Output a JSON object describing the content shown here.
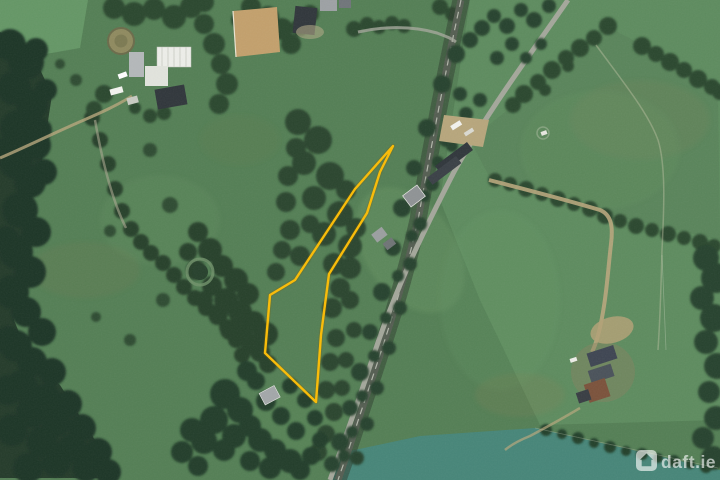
{
  "view": {
    "name": "satellite-map-view",
    "width": 720,
    "height": 480
  },
  "watermark": {
    "label": "daft.ie",
    "icon": "daft-house-icon",
    "color": "#FFFFFF",
    "opacity": 0.6
  },
  "boundary": {
    "label": "property-boundary-outline",
    "color": "#FBBC04",
    "underglow": "#7A5E00",
    "stroke_width": 2.4,
    "points": "393,146 380,172 367,213 329,274 321,335 316,402 265,353 270,295 295,280 355,189"
  },
  "scene": {
    "palette": {
      "field_base": "#547F55",
      "field_light": "#5E8C5F",
      "field_bright": "#659766",
      "field_teal": "#478679",
      "forest": "#243B2A",
      "forest_blob": "#1F3526",
      "hedge": "#2A462F",
      "corridor_shadow": "#2E3C2E",
      "road": "#A4A79B",
      "rail": "#555E52",
      "rail_line": "#C9CCC0",
      "track_tan": "#B7A67C",
      "arena_sand": "#C3A06C",
      "roof_white": "#EDEEE9",
      "roof_dark": "#30363B",
      "roof_grey": "#9B9FA0",
      "roof_brown": "#7B523B"
    },
    "paths": {
      "main_road": "M568,0 C530,55 492,105 455,170 C420,238 395,290 372,360 C352,420 340,452 330,480",
      "railway": "M461,0 C448,60 436,120 418,220 C400,300 378,360 355,430 C347,455 342,468 338,480",
      "farm_track_right": "M489,180 C520,188 560,198 600,210 C612,215 613,228 611,244 C608,270 607,290 603,312 C600,330 596,344 592,352",
      "farm_lane_bottom_right": "M580,408 C560,420 545,428 530,436 C520,440 512,444 505,450",
      "driveway_top_left": "M132,96 C116,106 100,113 84,120 C56,132 28,146 0,158",
      "driveway_top_center": "M358,32 C380,27 410,25 437,33 C445,36 451,38 456,42",
      "lane_hedge_a": "M95,120 C102,160 112,200 126,228",
      "field_path_right": "M596,45 C620,78 648,112 658,140 C666,165 664,210 662,250 C661,290 660,320 658,350",
      "forest_outline": "M0,32 L30,48 L52,95 L42,160 L28,210 L20,265 L14,320 L30,360 L60,385 L95,440 L115,478 L0,478 Z",
      "teal_field": "M535,428 L720,470 L720,480 L330,480 L345,452 L420,436 Z",
      "right_fields": "M470,0 L720,0 L720,420 L540,425 L480,300 L440,200 Z",
      "roadside_yard": "M444,115 L489,120 L483,147 L439,141 Z",
      "arena": "M233,11 L277,7 L280,52 L236,57 Z"
    },
    "trees": {
      "left_forest": [
        [
          10,
          45,
          16
        ],
        [
          26,
          62,
          18
        ],
        [
          14,
          88,
          17
        ],
        [
          32,
          105,
          16
        ],
        [
          18,
          128,
          18
        ],
        [
          36,
          145,
          15
        ],
        [
          16,
          162,
          17
        ],
        [
          30,
          182,
          16
        ],
        [
          44,
          172,
          13
        ],
        [
          20,
          210,
          18
        ],
        [
          36,
          232,
          15
        ],
        [
          16,
          252,
          17
        ],
        [
          30,
          272,
          16
        ],
        [
          12,
          292,
          17
        ],
        [
          26,
          312,
          15
        ],
        [
          42,
          332,
          14
        ],
        [
          16,
          346,
          16
        ],
        [
          32,
          362,
          15
        ],
        [
          52,
          372,
          14
        ],
        [
          22,
          386,
          16
        ],
        [
          46,
          398,
          15
        ],
        [
          68,
          404,
          14
        ],
        [
          32,
          412,
          16
        ],
        [
          56,
          422,
          15
        ],
        [
          82,
          428,
          14
        ],
        [
          42,
          442,
          16
        ],
        [
          72,
          448,
          15
        ],
        [
          98,
          452,
          14
        ],
        [
          56,
          462,
          15
        ],
        [
          86,
          468,
          14
        ],
        [
          108,
          472,
          13
        ],
        [
          28,
          468,
          15
        ],
        [
          12,
          430,
          16
        ],
        [
          8,
          390,
          15
        ],
        [
          8,
          340,
          14
        ],
        [
          6,
          240,
          14
        ],
        [
          8,
          150,
          14
        ],
        [
          40,
          130,
          12
        ],
        [
          46,
          90,
          11
        ],
        [
          36,
          50,
          12
        ]
      ],
      "scrub_center": [
        [
          198,
          232,
          10
        ],
        [
          210,
          250,
          12
        ],
        [
          222,
          266,
          11
        ],
        [
          236,
          280,
          12
        ],
        [
          248,
          294,
          11
        ],
        [
          226,
          300,
          12
        ],
        [
          212,
          286,
          10
        ],
        [
          240,
          312,
          12
        ],
        [
          254,
          322,
          11
        ],
        [
          266,
          334,
          12
        ],
        [
          252,
          344,
          11
        ],
        [
          242,
          330,
          10
        ],
        [
          188,
          252,
          9
        ],
        [
          196,
          270,
          10
        ],
        [
          204,
          300,
          9
        ],
        [
          230,
          330,
          10
        ],
        [
          218,
          314,
          10
        ],
        [
          260,
          352,
          10
        ],
        [
          268,
          364,
          9
        ]
      ],
      "polygon_scrub": [
        [
          298,
          122,
          13
        ],
        [
          318,
          140,
          14
        ],
        [
          304,
          163,
          12
        ],
        [
          330,
          176,
          14
        ],
        [
          314,
          198,
          12
        ],
        [
          340,
          214,
          13
        ],
        [
          324,
          234,
          12
        ],
        [
          350,
          246,
          12
        ],
        [
          334,
          264,
          11
        ],
        [
          300,
          256,
          10
        ],
        [
          290,
          230,
          10
        ],
        [
          286,
          202,
          10
        ],
        [
          310,
          224,
          9
        ],
        [
          346,
          190,
          10
        ],
        [
          356,
          228,
          10
        ],
        [
          350,
          268,
          11
        ],
        [
          340,
          288,
          10
        ],
        [
          332,
          308,
          10
        ],
        [
          336,
          338,
          9
        ],
        [
          330,
          362,
          9
        ],
        [
          326,
          390,
          9
        ],
        [
          350,
          300,
          9
        ],
        [
          354,
          330,
          8
        ],
        [
          346,
          360,
          8
        ],
        [
          342,
          388,
          8
        ],
        [
          334,
          412,
          9
        ],
        [
          326,
          434,
          9
        ],
        [
          318,
          452,
          9
        ],
        [
          288,
          176,
          10
        ],
        [
          296,
          148,
          10
        ],
        [
          282,
          250,
          9
        ],
        [
          276,
          272,
          9
        ]
      ],
      "corridor": [
        [
          456,
          54,
          9
        ],
        [
          470,
          40,
          8
        ],
        [
          442,
          84,
          9
        ],
        [
          460,
          94,
          7
        ],
        [
          427,
          128,
          9
        ],
        [
          446,
          140,
          7
        ],
        [
          414,
          168,
          8
        ],
        [
          432,
          184,
          7
        ],
        [
          402,
          208,
          9
        ],
        [
          420,
          224,
          7
        ],
        [
          393,
          248,
          8
        ],
        [
          410,
          264,
          7
        ],
        [
          382,
          292,
          9
        ],
        [
          400,
          308,
          7
        ],
        [
          370,
          332,
          8
        ],
        [
          389,
          348,
          7
        ],
        [
          360,
          372,
          9
        ],
        [
          377,
          388,
          7
        ],
        [
          350,
          408,
          8
        ],
        [
          367,
          424,
          7
        ],
        [
          340,
          442,
          9
        ],
        [
          357,
          458,
          7
        ],
        [
          332,
          464,
          8
        ],
        [
          482,
          28,
          8
        ],
        [
          494,
          16,
          7
        ],
        [
          507,
          26,
          8
        ],
        [
          521,
          10,
          7
        ],
        [
          534,
          20,
          8
        ],
        [
          549,
          6,
          7
        ],
        [
          497,
          58,
          7
        ],
        [
          512,
          44,
          7
        ],
        [
          526,
          58,
          6
        ],
        [
          541,
          44,
          6
        ],
        [
          466,
          114,
          7
        ],
        [
          480,
          100,
          7
        ],
        [
          452,
          146,
          6
        ],
        [
          438,
          162,
          6
        ],
        [
          424,
          196,
          6
        ],
        [
          412,
          236,
          6
        ],
        [
          398,
          276,
          6
        ],
        [
          386,
          318,
          6
        ],
        [
          374,
          356,
          6
        ],
        [
          362,
          396,
          6
        ],
        [
          352,
          432,
          6
        ],
        [
          344,
          456,
          6
        ]
      ],
      "hedge_h1": [
        [
          608,
          26,
          9
        ],
        [
          594,
          38,
          8
        ],
        [
          580,
          48,
          9
        ],
        [
          566,
          58,
          8
        ],
        [
          552,
          70,
          9
        ],
        [
          538,
          82,
          8
        ],
        [
          524,
          94,
          9
        ],
        [
          513,
          105,
          8
        ],
        [
          568,
          66,
          6
        ],
        [
          545,
          90,
          6
        ]
      ],
      "hedge_h3": [
        [
          642,
          46,
          9
        ],
        [
          656,
          54,
          8
        ],
        [
          670,
          62,
          9
        ],
        [
          684,
          70,
          8
        ],
        [
          698,
          79,
          9
        ],
        [
          712,
          87,
          8
        ],
        [
          720,
          92,
          8
        ]
      ],
      "hedge_h2": [
        [
          495,
          180,
          7
        ],
        [
          510,
          184,
          7
        ],
        [
          526,
          189,
          8
        ],
        [
          542,
          194,
          7
        ],
        [
          558,
          199,
          8
        ],
        [
          574,
          204,
          7
        ],
        [
          590,
          209,
          8
        ],
        [
          605,
          216,
          8
        ],
        [
          620,
          221,
          7
        ],
        [
          636,
          226,
          8
        ],
        [
          652,
          230,
          7
        ],
        [
          668,
          234,
          8
        ],
        [
          684,
          238,
          7
        ],
        [
          700,
          242,
          8
        ],
        [
          714,
          246,
          7
        ]
      ],
      "right_edge": [
        [
          706,
          258,
          13
        ],
        [
          716,
          278,
          15
        ],
        [
          702,
          298,
          12
        ],
        [
          714,
          318,
          14
        ],
        [
          706,
          342,
          12
        ],
        [
          717,
          366,
          13
        ],
        [
          709,
          392,
          11
        ],
        [
          716,
          418,
          12
        ],
        [
          703,
          438,
          11
        ],
        [
          713,
          458,
          12
        ]
      ],
      "teal_hedge": [
        [
          546,
          430,
          6
        ],
        [
          562,
          434,
          5
        ],
        [
          578,
          438,
          6
        ],
        [
          594,
          443,
          5
        ],
        [
          610,
          447,
          6
        ],
        [
          626,
          451,
          5
        ],
        [
          642,
          454,
          6
        ],
        [
          658,
          458,
          5
        ],
        [
          674,
          461,
          6
        ],
        [
          690,
          464,
          5
        ],
        [
          706,
          467,
          6
        ]
      ],
      "hedge_a": [
        [
          92,
          118,
          8
        ],
        [
          100,
          140,
          8
        ],
        [
          108,
          164,
          8
        ],
        [
          115,
          189,
          8
        ],
        [
          122,
          211,
          8
        ],
        [
          131,
          229,
          8
        ],
        [
          141,
          242,
          8
        ],
        [
          151,
          253,
          8
        ],
        [
          163,
          263,
          8
        ],
        [
          174,
          275,
          8
        ],
        [
          184,
          287,
          8
        ],
        [
          195,
          298,
          8
        ],
        [
          206,
          308,
          8
        ],
        [
          217,
          317,
          8
        ],
        [
          227,
          327,
          8
        ],
        [
          236,
          340,
          8
        ],
        [
          242,
          355,
          8
        ],
        [
          246,
          370,
          8
        ]
      ],
      "bottom_center": [
        [
          225,
          394,
          15
        ],
        [
          240,
          410,
          13
        ],
        [
          214,
          420,
          14
        ],
        [
          234,
          436,
          12
        ],
        [
          250,
          426,
          11
        ],
        [
          260,
          440,
          12
        ],
        [
          275,
          450,
          11
        ],
        [
          290,
          461,
          12
        ],
        [
          224,
          450,
          11
        ],
        [
          204,
          441,
          13
        ],
        [
          250,
          461,
          10
        ],
        [
          270,
          468,
          11
        ],
        [
          300,
          470,
          10
        ],
        [
          311,
          456,
          9
        ],
        [
          296,
          431,
          9
        ],
        [
          281,
          416,
          9
        ],
        [
          266,
          401,
          10
        ],
        [
          256,
          381,
          9
        ],
        [
          247,
          371,
          10
        ],
        [
          290,
          386,
          8
        ],
        [
          305,
          400,
          8
        ],
        [
          315,
          418,
          8
        ],
        [
          320,
          440,
          8
        ],
        [
          192,
          430,
          12
        ],
        [
          182,
          452,
          11
        ],
        [
          198,
          466,
          10
        ]
      ],
      "top_edge": [
        [
          114,
          8,
          11
        ],
        [
          134,
          14,
          12
        ],
        [
          154,
          9,
          11
        ],
        [
          174,
          17,
          12
        ],
        [
          191,
          7,
          11
        ],
        [
          204,
          24,
          10
        ],
        [
          214,
          44,
          11
        ],
        [
          221,
          64,
          10
        ],
        [
          227,
          84,
          11
        ],
        [
          219,
          104,
          10
        ],
        [
          268,
          17,
          11
        ],
        [
          282,
          29,
          11
        ],
        [
          291,
          44,
          10
        ],
        [
          259,
          34,
          9
        ],
        [
          251,
          7,
          10
        ],
        [
          300,
          27,
          9
        ],
        [
          310,
          14,
          9
        ],
        [
          354,
          29,
          8
        ],
        [
          367,
          24,
          7
        ],
        [
          379,
          27,
          7
        ],
        [
          392,
          23,
          7
        ],
        [
          404,
          26,
          7
        ],
        [
          440,
          7,
          8
        ],
        [
          452,
          14,
          7
        ],
        [
          204,
          2,
          10
        ],
        [
          240,
          20,
          9
        ]
      ],
      "farm_topleft": [
        [
          104,
          94,
          9
        ],
        [
          94,
          109,
          8
        ],
        [
          150,
          116,
          7
        ],
        [
          164,
          113,
          7
        ],
        [
          135,
          108,
          6
        ]
      ],
      "lone": [
        [
          150,
          150,
          7
        ],
        [
          170,
          205,
          8
        ],
        [
          110,
          231,
          6
        ],
        [
          163,
          300,
          7
        ],
        [
          130,
          340,
          6
        ],
        [
          96,
          317,
          5
        ],
        [
          76,
          80,
          6
        ],
        [
          60,
          64,
          5
        ]
      ]
    }
  }
}
